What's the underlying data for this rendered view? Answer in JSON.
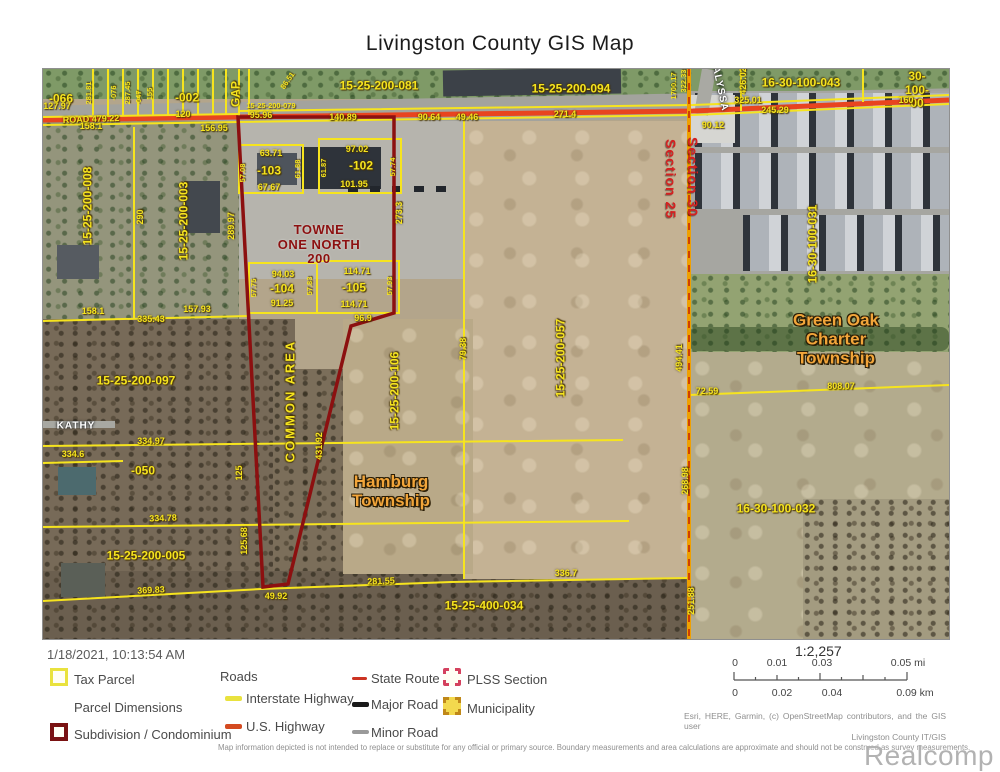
{
  "title": "Livingston County GIS Map",
  "timestamp": "1/18/2021, 10:13:54 AM",
  "colors": {
    "parcel": "#f6e41e",
    "highway": "#e8441f",
    "subdivision": "#8c1010",
    "section_line": "#f0a000",
    "section_text": "#d42020",
    "township": "#f2a53a",
    "towne_text": "#8c1010"
  },
  "legend": {
    "tax_parcel": "Tax Parcel",
    "parcel_dimensions": "Parcel Dimensions",
    "subdivision": "Subdivision / Condominium",
    "roads_header": "Roads",
    "interstate": "Interstate Highway",
    "us_highway": "U.S. Highway",
    "state_route": "State Route",
    "major_road": "Major Road",
    "minor_road": "Minor Road",
    "plss_section": "PLSS Section",
    "municipality": "Municipality"
  },
  "scale": {
    "ratio": "1:2,257",
    "mi_ticks": [
      "0",
      "0.01",
      "0.03",
      "0.05 mi"
    ],
    "km_ticks": [
      "0",
      "0.02",
      "0.04",
      "0.09 km"
    ]
  },
  "attribution": {
    "sources": "Esri, HERE, Garmin, (c) OpenStreetMap contributors, and the GIS user",
    "agency": "Livingston County IT/GIS",
    "disclaimer": "Map information depicted is not intended to replace or substitute for any official or primary source. Boundary measurements and area calculations are approximate and should not be construed as survey measurements.",
    "watermark": "Realcomp"
  },
  "map": {
    "townships": [
      "Hamburg Township",
      "Green Oak Charter Township"
    ],
    "labels": [
      {
        "t": "-066",
        "x": 18,
        "y": 30,
        "c": "pid"
      },
      {
        "t": "-002",
        "x": 144,
        "y": 29,
        "c": "pid"
      },
      {
        "t": "15-25-200-081",
        "x": 336,
        "y": 17,
        "c": "pid"
      },
      {
        "t": "15-25-200-094",
        "x": 528,
        "y": 20,
        "c": "pid"
      },
      {
        "t": "16-30-100-043",
        "x": 758,
        "y": 14,
        "c": "pid"
      },
      {
        "t": "16-30-100-00",
        "x": 874,
        "y": 15,
        "c": "pid"
      },
      {
        "t": "GAP",
        "x": 193,
        "y": 25,
        "c": "pid",
        "r": -90
      },
      {
        "t": "-103",
        "x": 226,
        "y": 102,
        "c": "pid"
      },
      {
        "t": "-102",
        "x": 318,
        "y": 97,
        "c": "pid"
      },
      {
        "t": "-104",
        "x": 239,
        "y": 220,
        "c": "pid"
      },
      {
        "t": "-105",
        "x": 311,
        "y": 219,
        "c": "pid"
      },
      {
        "t": "15-25-200-008",
        "x": 45,
        "y": 137,
        "c": "pid",
        "r": -90
      },
      {
        "t": "15-25-200-003",
        "x": 141,
        "y": 152,
        "c": "pid",
        "r": -90
      },
      {
        "t": "15-25-200-097",
        "x": 93,
        "y": 312,
        "c": "pid"
      },
      {
        "t": "-050",
        "x": 100,
        "y": 402,
        "c": "pid"
      },
      {
        "t": "15-25-200-005",
        "x": 103,
        "y": 487,
        "c": "pid"
      },
      {
        "t": "15-25-400-034",
        "x": 441,
        "y": 537,
        "c": "pid"
      },
      {
        "t": "16-30-100-032",
        "x": 733,
        "y": 440,
        "c": "pid"
      },
      {
        "t": "16-30-100-031",
        "x": 770,
        "y": 175,
        "c": "pid",
        "r": -90
      },
      {
        "t": "15-25-200-106",
        "x": 352,
        "y": 322,
        "c": "pid",
        "r": -90
      },
      {
        "t": "15-25-200-057",
        "x": 518,
        "y": 289,
        "c": "pid",
        "r": -90
      },
      {
        "t": "COMMON AREA",
        "x": 248,
        "y": 332,
        "c": "pid ls",
        "r": -90
      },
      {
        "t": "127.97",
        "x": 14,
        "y": 37,
        "c": "dim"
      },
      {
        "t": "ROAD 479.22",
        "x": 48,
        "y": 50,
        "c": "dim",
        "r": -2
      },
      {
        "t": "158.1",
        "x": 48,
        "y": 57,
        "c": "dim"
      },
      {
        "t": "120",
        "x": 140,
        "y": 45,
        "c": "dim"
      },
      {
        "t": "156.95",
        "x": 171,
        "y": 59,
        "c": "dim"
      },
      {
        "t": "15-25-200-079",
        "x": 228,
        "y": 37,
        "c": "dimsm"
      },
      {
        "t": "95.96",
        "x": 218,
        "y": 46,
        "c": "dim"
      },
      {
        "t": "140.89",
        "x": 300,
        "y": 48,
        "c": "dim"
      },
      {
        "t": "90.64",
        "x": 386,
        "y": 48,
        "c": "dim"
      },
      {
        "t": "49.46",
        "x": 424,
        "y": 48,
        "c": "dim"
      },
      {
        "t": "271.4",
        "x": 522,
        "y": 45,
        "c": "dim"
      },
      {
        "t": "90.12",
        "x": 670,
        "y": 56,
        "c": "dim"
      },
      {
        "t": "325.01",
        "x": 705,
        "y": 31,
        "c": "dim"
      },
      {
        "t": "245.29",
        "x": 732,
        "y": 41,
        "c": "dim"
      },
      {
        "t": "160",
        "x": 863,
        "y": 31,
        "c": "dim"
      },
      {
        "t": "63.71",
        "x": 228,
        "y": 84,
        "c": "dim"
      },
      {
        "t": "67.67",
        "x": 226,
        "y": 118,
        "c": "dim"
      },
      {
        "t": "97.02",
        "x": 314,
        "y": 80,
        "c": "dim"
      },
      {
        "t": "101.95",
        "x": 311,
        "y": 115,
        "c": "dim"
      },
      {
        "t": "94.03",
        "x": 240,
        "y": 205,
        "c": "dim"
      },
      {
        "t": "91.25",
        "x": 239,
        "y": 234,
        "c": "dim"
      },
      {
        "t": "114.71",
        "x": 314,
        "y": 202,
        "c": "dim"
      },
      {
        "t": "114.71",
        "x": 311,
        "y": 235,
        "c": "dim"
      },
      {
        "t": "96.9",
        "x": 320,
        "y": 249,
        "c": "dim"
      },
      {
        "t": "335.43",
        "x": 108,
        "y": 250,
        "c": "dim"
      },
      {
        "t": "157.93",
        "x": 154,
        "y": 240,
        "c": "dim"
      },
      {
        "t": "158.1",
        "x": 50,
        "y": 242,
        "c": "dim"
      },
      {
        "t": "334.97",
        "x": 108,
        "y": 372,
        "c": "dim"
      },
      {
        "t": "334.6",
        "x": 30,
        "y": 385,
        "c": "dim"
      },
      {
        "t": "334.78",
        "x": 120,
        "y": 449,
        "c": "dim",
        "r": -2
      },
      {
        "t": "369.83",
        "x": 108,
        "y": 521,
        "c": "dim",
        "r": -3
      },
      {
        "t": "49.92",
        "x": 233,
        "y": 527,
        "c": "dim"
      },
      {
        "t": "281.55",
        "x": 338,
        "y": 512,
        "c": "dim",
        "r": -2
      },
      {
        "t": "336.7",
        "x": 523,
        "y": 504,
        "c": "dim"
      },
      {
        "t": "72.59",
        "x": 664,
        "y": 322,
        "c": "dim"
      },
      {
        "t": "808.07",
        "x": 798,
        "y": 317,
        "c": "dim"
      },
      {
        "t": "290",
        "x": 97,
        "y": 148,
        "c": "dim",
        "r": -90
      },
      {
        "t": "289.97",
        "x": 188,
        "y": 157,
        "c": "dim",
        "r": -90
      },
      {
        "t": "273.3",
        "x": 356,
        "y": 144,
        "c": "dim",
        "r": -90
      },
      {
        "t": "431.92",
        "x": 276,
        "y": 377,
        "c": "dim",
        "r": -90
      },
      {
        "t": "125.68",
        "x": 201,
        "y": 472,
        "c": "dim",
        "r": -90
      },
      {
        "t": "125",
        "x": 196,
        "y": 404,
        "c": "dim",
        "r": -90
      },
      {
        "t": "79.38",
        "x": 420,
        "y": 280,
        "c": "dim",
        "r": -90
      },
      {
        "t": "268.98",
        "x": 642,
        "y": 412,
        "c": "dim",
        "r": -90
      },
      {
        "t": "251.88",
        "x": 648,
        "y": 532,
        "c": "dim",
        "r": -90
      },
      {
        "t": "494.41",
        "x": 636,
        "y": 289,
        "c": "dim",
        "r": -90
      },
      {
        "t": "426.02",
        "x": 700,
        "y": 12,
        "c": "dim",
        "r": -90
      },
      {
        "t": "322.33",
        "x": 641,
        "y": 12,
        "c": "dimsm",
        "r": -90
      },
      {
        "t": "1700.17",
        "x": 631,
        "y": 17,
        "c": "dimsm",
        "r": -90
      },
      {
        "t": "86.51",
        "x": 245,
        "y": 12,
        "c": "dimsm",
        "r": -55
      },
      {
        "t": "57.08",
        "x": 200,
        "y": 104,
        "c": "dimsm",
        "r": -90
      },
      {
        "t": "61.88",
        "x": 255,
        "y": 100,
        "c": "dimsm",
        "r": -90
      },
      {
        "t": "61.87",
        "x": 281,
        "y": 99,
        "c": "dimsm",
        "r": -90
      },
      {
        "t": "57.74",
        "x": 350,
        "y": 98,
        "c": "dimsm",
        "r": -90
      },
      {
        "t": "57.75",
        "x": 211,
        "y": 219,
        "c": "dimsm",
        "r": -90
      },
      {
        "t": "57.83",
        "x": 267,
        "y": 217,
        "c": "dimsm",
        "r": -90
      },
      {
        "t": "57.93",
        "x": 347,
        "y": 217,
        "c": "dimsm",
        "r": -90
      },
      {
        "t": "-076",
        "x": 71,
        "y": 24,
        "c": "dimsm",
        "r": -90
      },
      {
        "t": "287.45",
        "x": 85,
        "y": 24,
        "c": "dimsm",
        "r": -90
      },
      {
        "t": "-047",
        "x": 96,
        "y": 29,
        "c": "dimsm",
        "r": -90
      },
      {
        "t": "155",
        "x": 107,
        "y": 25,
        "c": "dimsm",
        "r": -90
      },
      {
        "t": "281.81",
        "x": 46,
        "y": 24,
        "c": "dimsm",
        "r": -90
      },
      {
        "t": "TOWNE\nONE NORTH\n200",
        "x": 276,
        "y": 176,
        "c": "towne"
      },
      {
        "t": "Hamburg\nTownship",
        "x": 348,
        "y": 422,
        "c": "town"
      },
      {
        "t": "Green Oak\nCharter\nTownship",
        "x": 793,
        "y": 270,
        "c": "town"
      },
      {
        "t": "Section 30",
        "x": 649,
        "y": 108,
        "c": "section",
        "r": 90
      },
      {
        "t": "Section 25",
        "x": 627,
        "y": 110,
        "c": "section",
        "r": 90
      },
      {
        "t": "KATHY",
        "x": 33,
        "y": 357,
        "c": "roadname"
      },
      {
        "t": "ALYSSA",
        "x": 677,
        "y": 20,
        "c": "roadname",
        "r": 78
      }
    ]
  }
}
